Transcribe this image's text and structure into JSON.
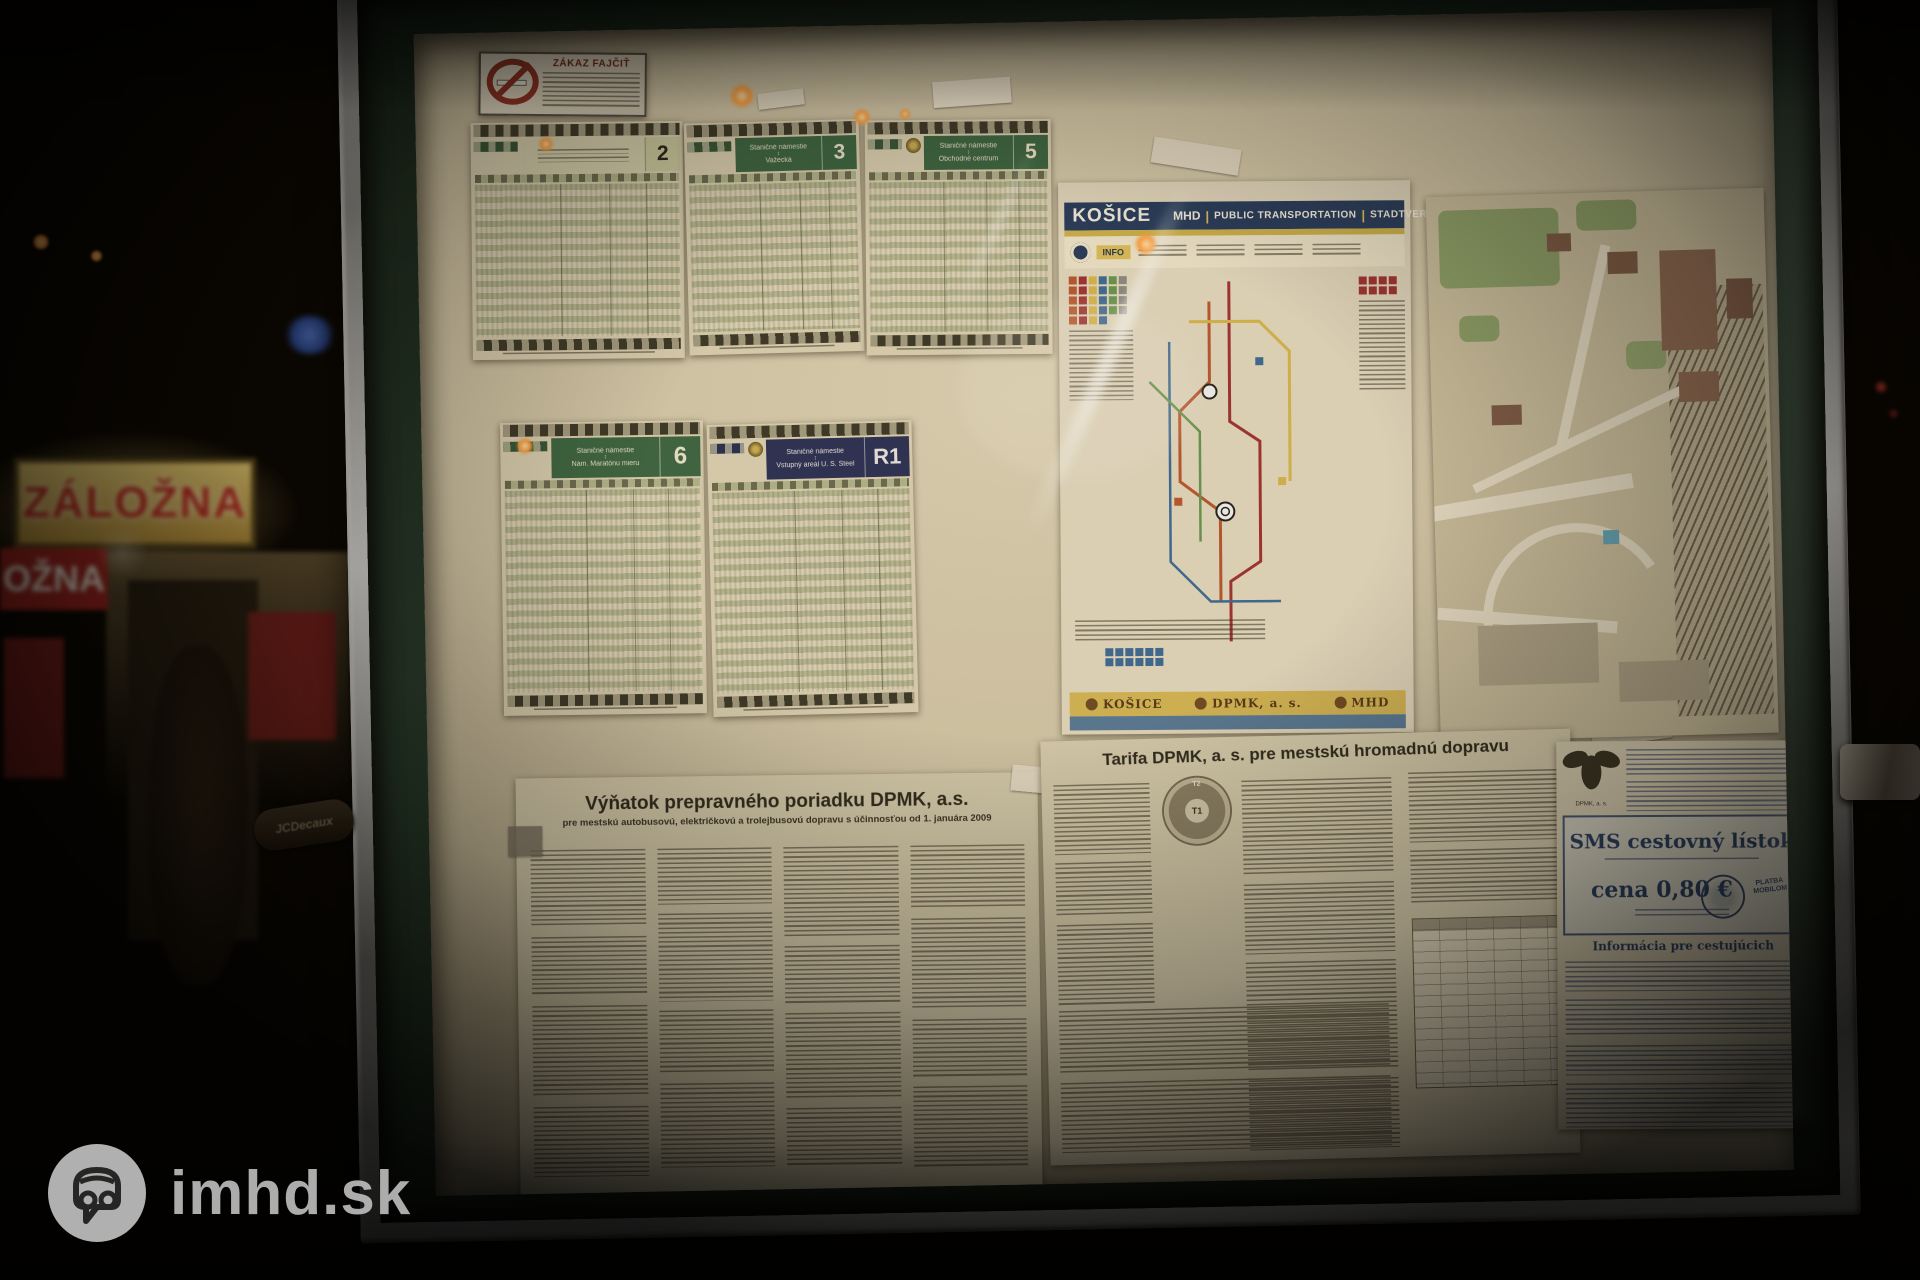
{
  "watermark": {
    "brand": "imhd.sk"
  },
  "street": {
    "shop_sign": "ZÁLOŽNA",
    "shop_sign_reflection": "OŽNA"
  },
  "case_hardware": {
    "left_latch_brand": "JCDecaux"
  },
  "no_smoking_sign": {
    "title": "ZÁKAZ FAJČIŤ"
  },
  "timetables": [
    {
      "badge": "2",
      "band_style": "light"
    },
    {
      "badge": "3",
      "band_style": "green",
      "from": "Staničné námestie",
      "to": "Važecká"
    },
    {
      "badge": "5",
      "band_style": "green",
      "from": "Staničné námestie",
      "to": "Obchodné centrum"
    },
    {
      "badge": "6",
      "band_style": "green",
      "from": "Staničné námestie",
      "to": "Nám. Maratónu mieru"
    },
    {
      "badge": "R1",
      "band_style": "navy",
      "from": "Staničné námestie",
      "to": "Vstupný areál U. S. Steel"
    }
  ],
  "network_map_poster": {
    "city": "KOŠICE",
    "mode": "MHD",
    "title_en": "PUBLIC TRANSPORTATION",
    "title_de": "STADTVERKEHR",
    "info_label": "INFO",
    "separator": "|",
    "footer_logos": {
      "city": "KOŠICE",
      "operator": "DPMK, a. s.",
      "media": "MHD"
    },
    "route_colors": [
      "#d94f1e",
      "#c2262e",
      "#e3b92e",
      "#2a6db5",
      "#58a146",
      "#8c8c8c"
    ]
  },
  "tariff_poster": {
    "heading": "Tarifa DPMK, a. s. pre mestskú hromadnú dopravu",
    "zones": {
      "inner": "T1",
      "outer": "T2"
    }
  },
  "transport_rules_poster": {
    "heading": "Výňatok prepravného poriadku DPMK, a.s.",
    "subheading": "pre mestskú autobusovú, električkovú a trolejbusovú dopravu s účinnosťou od 1. januára 2009"
  },
  "sms_ticket_poster": {
    "operator": "DPMK, a. s.",
    "title": "SMS cestovný lístok",
    "price": "cena 0,80 €",
    "stamp": "PLATBA MOBILOM",
    "info_heading": "Informácia pre cestujúcich"
  }
}
